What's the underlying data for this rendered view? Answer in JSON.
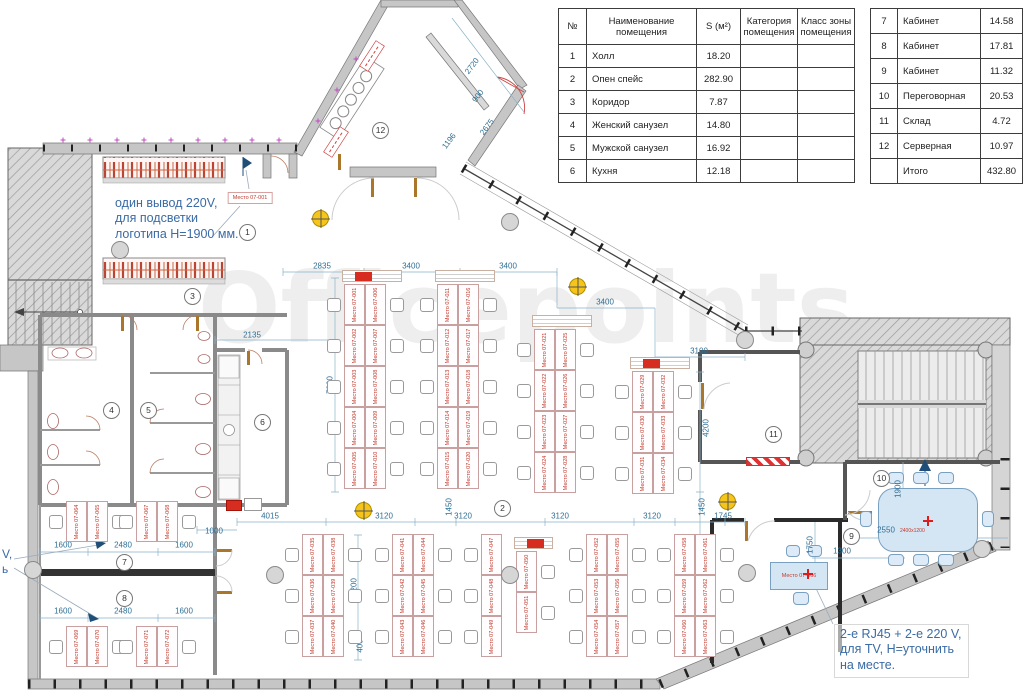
{
  "watermark": "Officepoints.",
  "annotations": {
    "logo_power": {
      "line1": "один вывод 220V,",
      "line2": "для подсветки",
      "line3": "логотипа H=1900 мм."
    },
    "tv_power": {
      "line1": "2-е RJ45 + 2-е 220 V,",
      "line2": "для TV, H=уточнить",
      "line3": "на месте."
    },
    "left_clipped": {
      "line1": "V,",
      "line2": "ь"
    }
  },
  "tables": {
    "main": {
      "headers": [
        "№",
        "Наименование\nпомещения",
        "S (м²)",
        "Категория\nпомещения",
        "Класс зоны\nпомещения"
      ],
      "rows": [
        [
          "1",
          "Холл",
          "18.20",
          "",
          ""
        ],
        [
          "2",
          "Опен спейс",
          "282.90",
          "",
          ""
        ],
        [
          "3",
          "Коридор",
          "7.87",
          "",
          ""
        ],
        [
          "4",
          "Женский санузел",
          "14.80",
          "",
          ""
        ],
        [
          "5",
          "Мужской санузел",
          "16.92",
          "",
          ""
        ],
        [
          "6",
          "Кухня",
          "12.18",
          "",
          ""
        ]
      ]
    },
    "side": {
      "rows": [
        [
          "7",
          "Кабинет",
          "14.58"
        ],
        [
          "8",
          "Кабинет",
          "17.81"
        ],
        [
          "9",
          "Кабинет",
          "11.32"
        ],
        [
          "10",
          "Переговорная",
          "20.53"
        ],
        [
          "11",
          "Склад",
          "4.72"
        ],
        [
          "12",
          "Серверная",
          "10.97"
        ],
        [
          "",
          "Итого",
          "432.80"
        ]
      ]
    }
  },
  "plan": {
    "room_circles": [
      {
        "n": "1",
        "x": 247,
        "y": 232
      },
      {
        "n": "2",
        "x": 502,
        "y": 508
      },
      {
        "n": "3",
        "x": 192,
        "y": 296
      },
      {
        "n": "4",
        "x": 111,
        "y": 410
      },
      {
        "n": "5",
        "x": 148,
        "y": 410
      },
      {
        "n": "6",
        "x": 262,
        "y": 422
      },
      {
        "n": "7",
        "x": 124,
        "y": 562
      },
      {
        "n": "8",
        "x": 124,
        "y": 598
      },
      {
        "n": "9",
        "x": 851,
        "y": 536
      },
      {
        "n": "10",
        "x": 881,
        "y": 478
      },
      {
        "n": "11",
        "x": 773,
        "y": 434
      },
      {
        "n": "12",
        "x": 380,
        "y": 130
      }
    ],
    "dimensions": [
      {
        "t": "2835",
        "x": 322,
        "y": 266
      },
      {
        "t": "3400",
        "x": 411,
        "y": 266
      },
      {
        "t": "3400",
        "x": 508,
        "y": 266
      },
      {
        "t": "3400",
        "x": 605,
        "y": 302
      },
      {
        "t": "3100",
        "x": 699,
        "y": 351
      },
      {
        "t": "2135",
        "x": 252,
        "y": 335
      },
      {
        "t": "7000",
        "x": 330,
        "y": 385,
        "r": -90
      },
      {
        "t": "2720",
        "x": 472,
        "y": 66,
        "r": -53
      },
      {
        "t": "900",
        "x": 478,
        "y": 96,
        "r": -53
      },
      {
        "t": "2675",
        "x": 487,
        "y": 127,
        "r": -53
      },
      {
        "t": "1196",
        "x": 449,
        "y": 141,
        "r": -53
      },
      {
        "t": "4200",
        "x": 706,
        "y": 428,
        "r": -90
      },
      {
        "t": "1000",
        "x": 214,
        "y": 531
      },
      {
        "t": "4015",
        "x": 270,
        "y": 516
      },
      {
        "t": "3120",
        "x": 384,
        "y": 516
      },
      {
        "t": "1450",
        "x": 449,
        "y": 507,
        "r": -90
      },
      {
        "t": "3120",
        "x": 463,
        "y": 516
      },
      {
        "t": "3120",
        "x": 560,
        "y": 516
      },
      {
        "t": "3120",
        "x": 652,
        "y": 516
      },
      {
        "t": "1450",
        "x": 702,
        "y": 507,
        "r": -90
      },
      {
        "t": "1745",
        "x": 723,
        "y": 516
      },
      {
        "t": "1600",
        "x": 63,
        "y": 545
      },
      {
        "t": "2480",
        "x": 123,
        "y": 545
      },
      {
        "t": "1600",
        "x": 184,
        "y": 545
      },
      {
        "t": "1600",
        "x": 63,
        "y": 611
      },
      {
        "t": "2480",
        "x": 123,
        "y": 611
      },
      {
        "t": "1600",
        "x": 184,
        "y": 611
      },
      {
        "t": "4200",
        "x": 354,
        "y": 587,
        "r": -90
      },
      {
        "t": "400",
        "x": 360,
        "y": 646,
        "r": -90
      },
      {
        "t": "1750",
        "x": 810,
        "y": 545,
        "r": -90
      },
      {
        "t": "1300",
        "x": 842,
        "y": 551
      },
      {
        "t": "1900",
        "x": 898,
        "y": 489,
        "r": -90
      },
      {
        "t": "2550",
        "x": 886,
        "y": 530
      }
    ],
    "desk_clusters": [
      {
        "x": 344,
        "y": 284,
        "rows": 5,
        "cols": 2,
        "chairs": "both",
        "header": "red",
        "labels": [
          "Место 07-001",
          "Место 07-002",
          "Место 07-003",
          "Место 07-004",
          "Место 07-005",
          "Место 07-006",
          "Место 07-007",
          "Место 07-008",
          "Место 07-009",
          "Место 07-010"
        ]
      },
      {
        "x": 437,
        "y": 284,
        "rows": 5,
        "cols": 2,
        "chairs": "both",
        "header": "plain",
        "labels": [
          "Место 07-011",
          "Место 07-012",
          "Место 07-013",
          "Место 07-014",
          "Место 07-015",
          "Место 07-016",
          "Место 07-017",
          "Место 07-018",
          "Место 07-019",
          "Место 07-020"
        ]
      },
      {
        "x": 534,
        "y": 329,
        "rows": 4,
        "cols": 2,
        "chairs": "both",
        "header": "plain",
        "labels": [
          "Место 07-021",
          "Место 07-022",
          "Место 07-023",
          "Место 07-024",
          "Место 07-025",
          "Место 07-026",
          "Место 07-027",
          "Место 07-028"
        ]
      },
      {
        "x": 632,
        "y": 371,
        "rows": 3,
        "cols": 2,
        "chairs": "both",
        "header": "red",
        "labels": [
          "Место 07-029",
          "Место 07-030",
          "Место 07-031",
          "Место 07-032",
          "Место 07-033",
          "Место 07-034"
        ]
      },
      {
        "x": 302,
        "y": 534,
        "rows": 3,
        "cols": 2,
        "chairs": "both",
        "labels": [
          "Место 07-035",
          "Место 07-036",
          "Место 07-037",
          "Место 07-038",
          "Место 07-039",
          "Место 07-040"
        ]
      },
      {
        "x": 392,
        "y": 534,
        "rows": 3,
        "cols": 2,
        "chairs": "both",
        "labels": [
          "Место 07-041",
          "Место 07-042",
          "Место 07-043",
          "Место 07-044",
          "Место 07-045",
          "Место 07-046"
        ]
      },
      {
        "x": 481,
        "y": 534,
        "rows": 3,
        "cols": 1,
        "chairs": "left",
        "labels": [
          "Место 07-047",
          "Место 07-048",
          "Место 07-049"
        ]
      },
      {
        "x": 516,
        "y": 551,
        "rows": 2,
        "cols": 1,
        "chairs": "right",
        "header": "red",
        "labels": [
          "Место 07-050",
          "Место 07-051"
        ]
      },
      {
        "x": 586,
        "y": 534,
        "rows": 3,
        "cols": 2,
        "chairs": "both",
        "labels": [
          "Место 07-052",
          "Место 07-053",
          "Место 07-054",
          "Место 07-055",
          "Место 07-056",
          "Место 07-057"
        ]
      },
      {
        "x": 674,
        "y": 534,
        "rows": 3,
        "cols": 2,
        "chairs": "both",
        "labels": [
          "Место 07-058",
          "Место 07-059",
          "Место 07-060",
          "Место 07-061",
          "Место 07-062",
          "Место 07-063"
        ]
      },
      {
        "x": 66,
        "y": 501,
        "rows": 1,
        "cols": 2,
        "chairs": "both",
        "labels": [
          "Место 07-064",
          "Место 07-065"
        ]
      },
      {
        "x": 136,
        "y": 501,
        "rows": 1,
        "cols": 2,
        "chairs": "both",
        "labels": [
          "Место 07-067",
          "Место 07-068"
        ]
      },
      {
        "x": 66,
        "y": 626,
        "rows": 1,
        "cols": 2,
        "chairs": "both",
        "labels": [
          "Место 07-069",
          "Место 07-070"
        ]
      },
      {
        "x": 136,
        "y": 626,
        "rows": 1,
        "cols": 2,
        "chairs": "both",
        "labels": [
          "Место 07-071",
          "Место 07-072"
        ]
      }
    ],
    "special_labels": [
      {
        "t": "Место 07-001",
        "x": 250,
        "y": 198,
        "boxed": true
      }
    ],
    "room9_desk": {
      "label": "Место 07-066"
    },
    "meeting_table": {
      "size_label": "2400х1200"
    },
    "markers_yellow": [
      [
        320,
        218
      ],
      [
        577,
        286
      ],
      [
        363,
        510
      ],
      [
        727,
        501
      ]
    ],
    "columns": [
      [
        120,
        250
      ],
      [
        510,
        222
      ],
      [
        745,
        340
      ],
      [
        275,
        575
      ],
      [
        510,
        575
      ],
      [
        747,
        573
      ],
      [
        33,
        570
      ],
      [
        982,
        549
      ]
    ],
    "power_points": [
      [
        928,
        521
      ],
      [
        808,
        574
      ]
    ],
    "red_boxes": [
      {
        "x": 226,
        "y": 500,
        "w": 16,
        "h": 11
      },
      {
        "x": 244,
        "y": 498,
        "w": 18,
        "h": 13,
        "outline": true
      },
      {
        "x": 746,
        "y": 457,
        "w": 44,
        "h": 9,
        "striped": true
      }
    ],
    "colors": {
      "dimension": "#2e6f94",
      "annotation": "#3a6ba5",
      "desk_label": "#c0392b",
      "marker_red": "#d62d20",
      "marker_yellow": "#f6c51c",
      "furniture_blue": "#d4e6f4"
    }
  }
}
